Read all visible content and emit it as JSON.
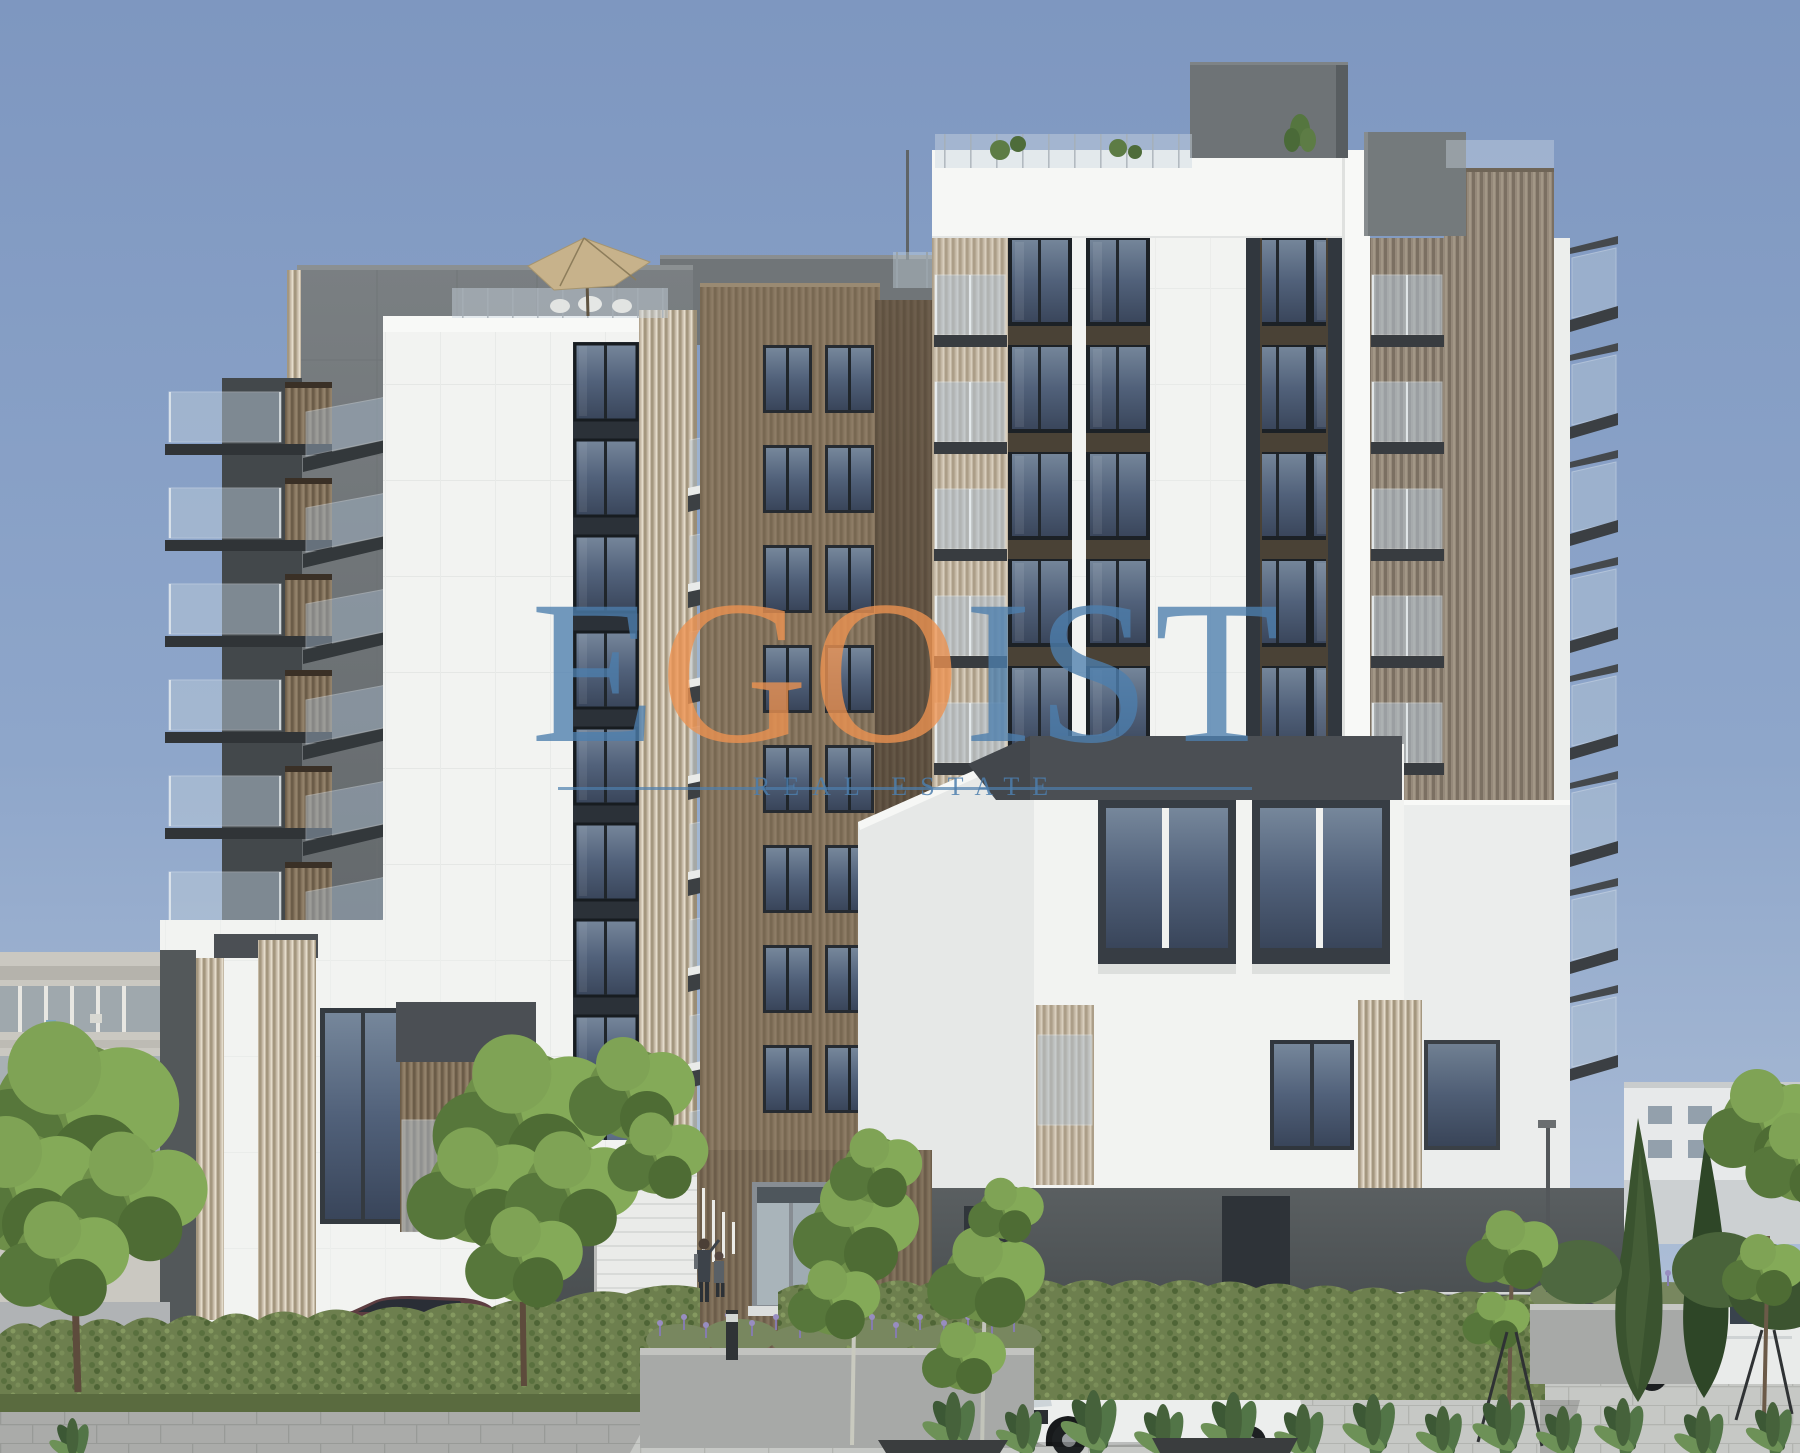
{
  "image": {
    "kind": "architectural rendering",
    "subject": "modern residential apartment complex with white, concrete and wood-slat facades, landscaped plaza, trees and parked cars"
  },
  "watermark": {
    "letters": [
      {
        "char": "E",
        "color": "#4d7fae"
      },
      {
        "char": "G",
        "color": "#ee9351"
      },
      {
        "char": "O",
        "color": "#ee9351"
      },
      {
        "char": "I",
        "color": "#4d7fae"
      },
      {
        "char": "S",
        "color": "#4d7fae"
      },
      {
        "char": "T",
        "color": "#4d7fae"
      }
    ],
    "tagline": "REAL ESTATE",
    "tagline_color": "#4d7fae",
    "line_color": "#4d7fae"
  },
  "palette": {
    "sky_top": "#7e97c0",
    "sky_bottom": "#b6c5da",
    "facade_white": "#f2f3f1",
    "facade_shaded": "#e6e8e7",
    "wood_brown": "#87765f",
    "wood_light": "#c6baa7",
    "wood_gray": "#95897a",
    "concrete_light": "#71767a",
    "concrete_dark": "#4c5153",
    "frame_dark": "#31373e",
    "glass_blue": "#51617a",
    "glass_rail": "#b7c8d8",
    "band_dark": "#4b4f54",
    "greenery": "#6e8f49",
    "hedge": "#6d7f4e",
    "pavement": "#c6c8c5",
    "car_maroon": "#5d3d41",
    "car_white": "#eceeed"
  }
}
